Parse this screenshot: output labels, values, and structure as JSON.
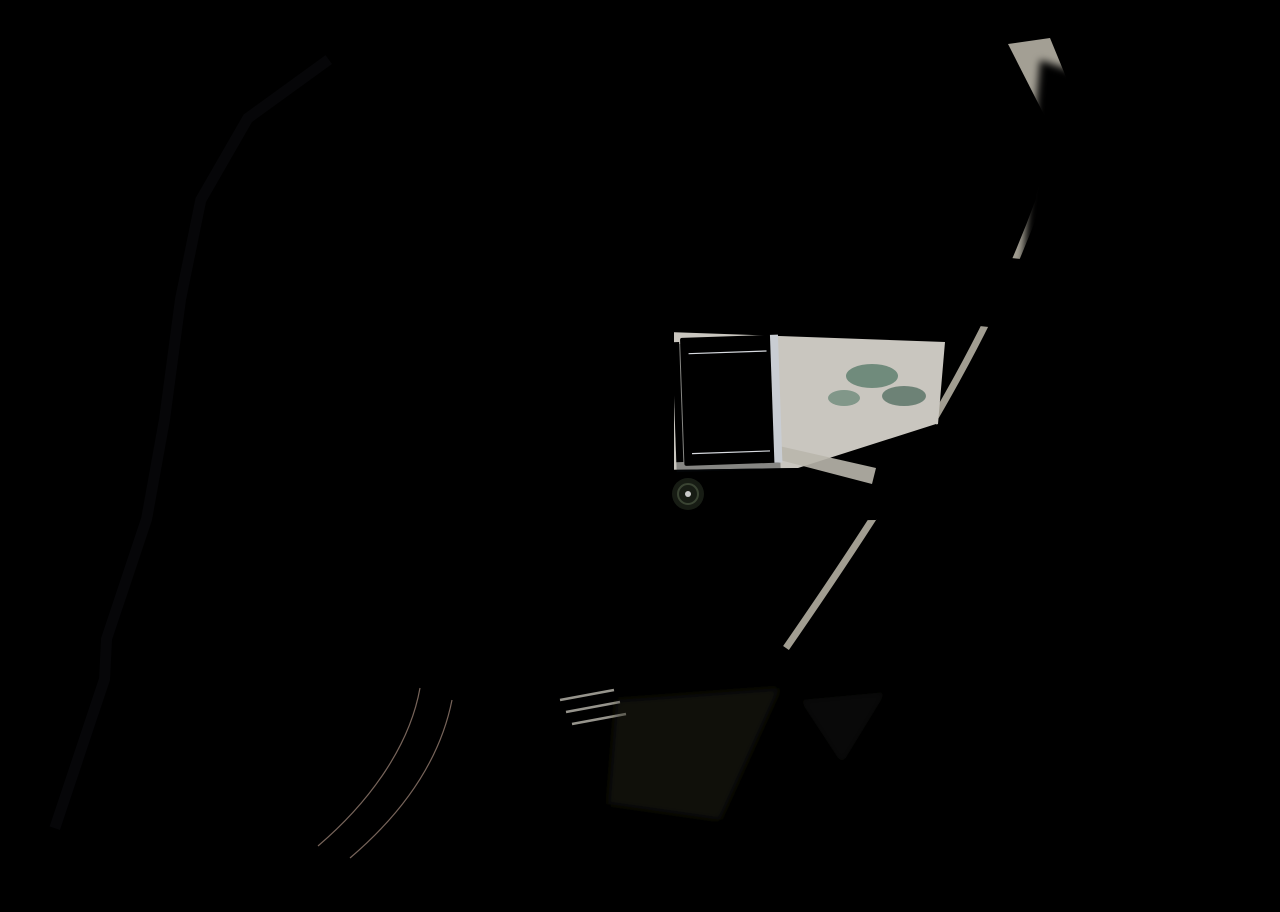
{
  "scene": {
    "description": "Aerial 3D render of a hillside residential villa development: white flat-roof villas with rooftop solar panels and terraces, private plunge pools, a central blue communal pool with white sun umbrellas, a lagoon pool, terraced gardens, curving gray access roads, a slate paver lane with parked cars, a tan paver drive, an entrance plaza, palm trees, lawns, olive grass and rock outcrops.",
    "width": 1280,
    "height": 912
  },
  "palette": {
    "grass": "#a9a43e",
    "grassLight": "#bdb54b",
    "grassDark": "#7d7a30",
    "road": "#cbc9c3",
    "roadShade": "#b7b5b0",
    "ground": "#262e3b",
    "groundDark": "#1a2029",
    "lawn": "#31481d",
    "lawnDark": "#243618",
    "hedge": "#1f3315",
    "paver": "#4e5a77",
    "paverTan": "#c2a795",
    "plaza": "#c5c1b8",
    "white": "#e9ebee",
    "roofShade": "#dde0e5",
    "inner": "#272e3b",
    "solar": "#121b2e",
    "solarLine": "#3d4a66",
    "heater": "#3c5f98",
    "teal": "#2d6a60",
    "tealDark": "#1f4f48",
    "poolBlue": "#1f6dab",
    "poolBlueLight": "#4aa0cd",
    "lagoon": "#4e6f5a",
    "palm": "#3f5c28",
    "palmDark": "#2c441d",
    "canopy": "#2f4a1e",
    "shadow": "rgba(15,20,10,0.42)",
    "rock": "#99a0a8",
    "rockLight": "#c6cbd1",
    "rockDark": "#4e545e",
    "curb": "#dfdfdb",
    "car": "#e8e9eb",
    "carDark": "#3a414d",
    "umbrella": "#e8eaec"
  },
  "villas": {
    "left_chain": [
      {
        "x": 183,
        "y": 42,
        "w": 175,
        "h": 86,
        "rot": 0
      },
      {
        "x": 128,
        "y": 152,
        "w": 172,
        "h": 86,
        "rot": -2
      },
      {
        "x": 136,
        "y": 250,
        "w": 156,
        "h": 84,
        "rot": -2
      },
      {
        "x": 176,
        "y": 340,
        "w": 150,
        "h": 80,
        "rot": -3
      },
      {
        "x": 194,
        "y": 424,
        "w": 150,
        "h": 80,
        "rot": -3
      },
      {
        "x": 205,
        "y": 506,
        "w": 148,
        "h": 78,
        "rot": -2
      },
      {
        "x": 200,
        "y": 604,
        "w": 136,
        "h": 62,
        "rot": -2
      },
      {
        "x": 158,
        "y": 684,
        "w": 130,
        "h": 62,
        "rot": -3
      },
      {
        "x": 126,
        "y": 754,
        "w": 128,
        "h": 64,
        "rot": -4
      },
      {
        "x": 78,
        "y": 832,
        "w": 118,
        "h": 52,
        "rot": -4
      }
    ],
    "middle_column": [
      {
        "x": 506,
        "y": 320,
        "w": 112,
        "h": 47,
        "rot": 0
      },
      {
        "x": 506,
        "y": 369,
        "w": 112,
        "h": 47,
        "rot": 0
      },
      {
        "x": 506,
        "y": 417,
        "w": 112,
        "h": 47,
        "rot": 0
      },
      {
        "x": 506,
        "y": 466,
        "w": 112,
        "h": 47,
        "rot": 0
      },
      {
        "x": 506,
        "y": 514,
        "w": 112,
        "h": 47,
        "rot": 0
      }
    ],
    "top_row_x": [
      442,
      522,
      603,
      683,
      760
    ],
    "top_row_y": 48,
    "right_pair": [
      {
        "x": 855,
        "y": 108,
        "w": 80
      },
      {
        "x": 956,
        "y": 106,
        "w": 72
      }
    ],
    "rotated": {
      "x": 1148,
      "y": 196,
      "rot": 24,
      "w": 150,
      "h": 96
    }
  },
  "pools": {
    "town": [
      {
        "x": 460,
        "y": 216
      },
      {
        "x": 543,
        "y": 220
      },
      {
        "x": 616,
        "y": 222
      },
      {
        "x": 690,
        "y": 224
      },
      {
        "x": 763,
        "y": 226
      }
    ],
    "town_size": {
      "w": 34,
      "h": 56
    },
    "right": [
      {
        "x": 850,
        "y": 276
      },
      {
        "x": 946,
        "y": 278
      }
    ],
    "right_size": {
      "w": 56,
      "h": 44
    },
    "rotated": {
      "x": 1068,
      "y": 262,
      "rot": 24,
      "w": 56,
      "h": 40
    },
    "main": {
      "x": 794,
      "y": 340,
      "w": 136,
      "h": 74
    },
    "lagoon_points": "726,446 872,484 862,512 716,476"
  },
  "umbrellas": [
    {
      "x": 742,
      "y": 452
    },
    {
      "x": 764,
      "y": 446
    },
    {
      "x": 786,
      "y": 440
    }
  ],
  "cars": [
    {
      "x": 424,
      "y": 288,
      "rot": 90
    },
    {
      "x": 447,
      "y": 288,
      "rot": 90
    },
    {
      "x": 480,
      "y": 336,
      "rot": 0
    },
    {
      "x": 480,
      "y": 385,
      "rot": 0
    },
    {
      "x": 480,
      "y": 433,
      "rot": 0
    },
    {
      "x": 480,
      "y": 482,
      "rot": 0
    },
    {
      "x": 480,
      "y": 530,
      "rot": 0
    },
    {
      "x": 362,
      "y": 608,
      "rot": 6
    },
    {
      "x": 368,
      "y": 642,
      "rot": 6
    },
    {
      "x": 356,
      "y": 680,
      "rot": 8
    },
    {
      "x": 352,
      "y": 744,
      "rot": 4
    },
    {
      "x": 352,
      "y": 764,
      "rot": 4
    },
    {
      "x": 288,
      "y": 828,
      "rot": 12
    },
    {
      "x": 114,
      "y": 858,
      "rot": 14
    },
    {
      "x": 446,
      "y": 830,
      "rot": 20
    }
  ],
  "trees": [
    {
      "k": "C",
      "x": 355,
      "y": 72,
      "r": 16
    },
    {
      "k": "P",
      "x": 345,
      "y": 96,
      "r": 13
    },
    {
      "k": "P",
      "x": 445,
      "y": 126,
      "r": 11
    },
    {
      "k": "P",
      "x": 475,
      "y": 66,
      "r": 10
    },
    {
      "k": "P",
      "x": 310,
      "y": 206,
      "r": 12
    },
    {
      "k": "P",
      "x": 368,
      "y": 252,
      "r": 11
    },
    {
      "k": "P",
      "x": 386,
      "y": 320,
      "r": 11
    },
    {
      "k": "P",
      "x": 398,
      "y": 390,
      "r": 11
    },
    {
      "k": "P",
      "x": 410,
      "y": 460,
      "r": 11
    },
    {
      "k": "P",
      "x": 420,
      "y": 530,
      "r": 11
    },
    {
      "k": "B",
      "x": 352,
      "y": 560,
      "r": 8
    },
    {
      "k": "B",
      "x": 300,
      "y": 640,
      "r": 8
    },
    {
      "k": "B",
      "x": 262,
      "y": 712,
      "r": 7
    },
    {
      "k": "B",
      "x": 236,
      "y": 782,
      "r": 7
    },
    {
      "k": "P",
      "x": 452,
      "y": 282,
      "r": 12
    },
    {
      "k": "P",
      "x": 497,
      "y": 290,
      "r": 12
    },
    {
      "k": "P",
      "x": 532,
      "y": 286,
      "r": 12
    },
    {
      "k": "P",
      "x": 574,
      "y": 292,
      "r": 12
    },
    {
      "k": "P",
      "x": 607,
      "y": 288,
      "r": 12
    },
    {
      "k": "P",
      "x": 649,
      "y": 294,
      "r": 12
    },
    {
      "k": "P",
      "x": 681,
      "y": 290,
      "r": 12
    },
    {
      "k": "P",
      "x": 723,
      "y": 296,
      "r": 12
    },
    {
      "k": "P",
      "x": 756,
      "y": 292,
      "r": 12
    },
    {
      "k": "P",
      "x": 798,
      "y": 298,
      "r": 12
    },
    {
      "k": "P",
      "x": 828,
      "y": 304,
      "r": 12
    },
    {
      "k": "P",
      "x": 836,
      "y": 240,
      "r": 10
    },
    {
      "k": "P",
      "x": 864,
      "y": 312,
      "r": 11
    },
    {
      "k": "P",
      "x": 947,
      "y": 316,
      "r": 11
    },
    {
      "k": "P",
      "x": 1036,
      "y": 300,
      "r": 12
    },
    {
      "k": "P",
      "x": 700,
      "y": 318,
      "r": 11
    },
    {
      "k": "P",
      "x": 742,
      "y": 322,
      "r": 11
    },
    {
      "k": "P",
      "x": 786,
      "y": 326,
      "r": 11
    },
    {
      "k": "P",
      "x": 1008,
      "y": 332,
      "r": 10
    },
    {
      "k": "P",
      "x": 984,
      "y": 362,
      "r": 9
    },
    {
      "k": "P",
      "x": 960,
      "y": 394,
      "r": 9
    },
    {
      "k": "P",
      "x": 936,
      "y": 426,
      "r": 9
    },
    {
      "k": "P",
      "x": 912,
      "y": 458,
      "r": 9
    },
    {
      "k": "P",
      "x": 888,
      "y": 490,
      "r": 9
    },
    {
      "k": "P",
      "x": 864,
      "y": 522,
      "r": 9
    },
    {
      "k": "P",
      "x": 840,
      "y": 554,
      "r": 9
    },
    {
      "k": "P",
      "x": 816,
      "y": 586,
      "r": 9
    },
    {
      "k": "P",
      "x": 795,
      "y": 616,
      "r": 9
    },
    {
      "k": "P",
      "x": 776,
      "y": 644,
      "r": 9
    },
    {
      "k": "P",
      "x": 718,
      "y": 494,
      "r": 11
    },
    {
      "k": "P",
      "x": 758,
      "y": 502,
      "r": 11
    },
    {
      "k": "P",
      "x": 804,
      "y": 508,
      "r": 11
    },
    {
      "k": "P",
      "x": 880,
      "y": 472,
      "r": 10
    },
    {
      "k": "C",
      "x": 620,
      "y": 560,
      "r": 22
    },
    {
      "k": "C",
      "x": 688,
      "y": 600,
      "r": 24
    },
    {
      "k": "C",
      "x": 752,
      "y": 562,
      "r": 22
    },
    {
      "k": "C",
      "x": 816,
      "y": 522,
      "r": 22
    },
    {
      "k": "C",
      "x": 878,
      "y": 482,
      "r": 20
    },
    {
      "k": "C",
      "x": 928,
      "y": 442,
      "r": 18
    },
    {
      "k": "C",
      "x": 700,
      "y": 676,
      "r": 24
    },
    {
      "k": "C",
      "x": 764,
      "y": 650,
      "r": 22
    },
    {
      "k": "C",
      "x": 842,
      "y": 612,
      "r": 22
    },
    {
      "k": "C",
      "x": 900,
      "y": 562,
      "r": 20
    },
    {
      "k": "C",
      "x": 948,
      "y": 506,
      "r": 18
    },
    {
      "k": "C",
      "x": 646,
      "y": 658,
      "r": 22
    },
    {
      "k": "C",
      "x": 610,
      "y": 710,
      "r": 20
    },
    {
      "k": "C",
      "x": 588,
      "y": 640,
      "r": 18
    },
    {
      "k": "P",
      "x": 390,
      "y": 700,
      "r": 12
    },
    {
      "k": "P",
      "x": 420,
      "y": 754,
      "r": 12
    },
    {
      "k": "P",
      "x": 462,
      "y": 800,
      "r": 12
    },
    {
      "k": "P",
      "x": 512,
      "y": 844,
      "r": 12
    },
    {
      "k": "P",
      "x": 560,
      "y": 880,
      "r": 12
    },
    {
      "k": "P",
      "x": 330,
      "y": 848,
      "r": 11
    },
    {
      "k": "P",
      "x": 302,
      "y": 884,
      "r": 10
    },
    {
      "k": "P",
      "x": 608,
      "y": 906,
      "r": 11
    },
    {
      "k": "C",
      "x": 722,
      "y": 864,
      "r": 20
    },
    {
      "k": "C",
      "x": 664,
      "y": 896,
      "r": 18
    },
    {
      "k": "C",
      "x": 955,
      "y": 668,
      "r": 20
    },
    {
      "k": "C",
      "x": 1012,
      "y": 688,
      "r": 18
    },
    {
      "k": "B",
      "x": 642,
      "y": 352,
      "r": 6
    },
    {
      "k": "B",
      "x": 642,
      "y": 420,
      "r": 6
    },
    {
      "k": "B",
      "x": 642,
      "y": 488,
      "r": 6
    },
    {
      "k": "B",
      "x": 642,
      "y": 550,
      "r": 6
    },
    {
      "k": "B",
      "x": 196,
      "y": 262,
      "r": 7
    },
    {
      "k": "B",
      "x": 178,
      "y": 360,
      "r": 7
    },
    {
      "k": "B",
      "x": 158,
      "y": 468,
      "r": 6
    },
    {
      "k": "B",
      "x": 128,
      "y": 590,
      "r": 7
    },
    {
      "k": "B",
      "x": 100,
      "y": 688,
      "r": 6
    },
    {
      "k": "B",
      "x": 64,
      "y": 802,
      "r": 7
    }
  ],
  "rocks": {
    "clusters": [
      [
        [
          34,
          100,
          26
        ],
        [
          58,
          150,
          30
        ],
        [
          82,
          196,
          22
        ],
        [
          46,
          206,
          16
        ]
      ],
      [
        [
          1000,
          742,
          26
        ],
        [
          1048,
          768,
          34
        ],
        [
          1102,
          800,
          38
        ],
        [
          1160,
          836,
          30
        ],
        [
          1210,
          866,
          24
        ],
        [
          1062,
          732,
          18
        ]
      ],
      [
        [
          1252,
          590,
          14
        ],
        [
          1268,
          620,
          10
        ]
      ]
    ]
  },
  "terraces": {
    "x": 572,
    "y": 560,
    "count": 7,
    "side": [
      250,
      -95
    ],
    "width": [
      7,
      18
    ],
    "step": [
      8.5,
      22.4
    ]
  },
  "shadow_steps": [
    [
      600,
      46
    ],
    [
      660,
      47
    ],
    [
      724,
      48
    ],
    [
      788,
      49
    ],
    [
      852,
      51
    ],
    [
      912,
      68
    ],
    [
      968,
      87
    ]
  ],
  "hedges": [
    [
      342,
      68,
      92,
      10
    ],
    [
      348,
      82,
      78,
      8
    ],
    [
      436,
      66,
      12,
      58
    ],
    [
      190,
      255,
      12,
      34
    ],
    [
      172,
      356,
      12,
      34
    ],
    [
      156,
      466,
      10,
      30
    ],
    [
      122,
      588,
      12,
      34
    ],
    [
      96,
      686,
      10,
      30
    ],
    [
      58,
      798,
      12,
      40
    ]
  ]
}
